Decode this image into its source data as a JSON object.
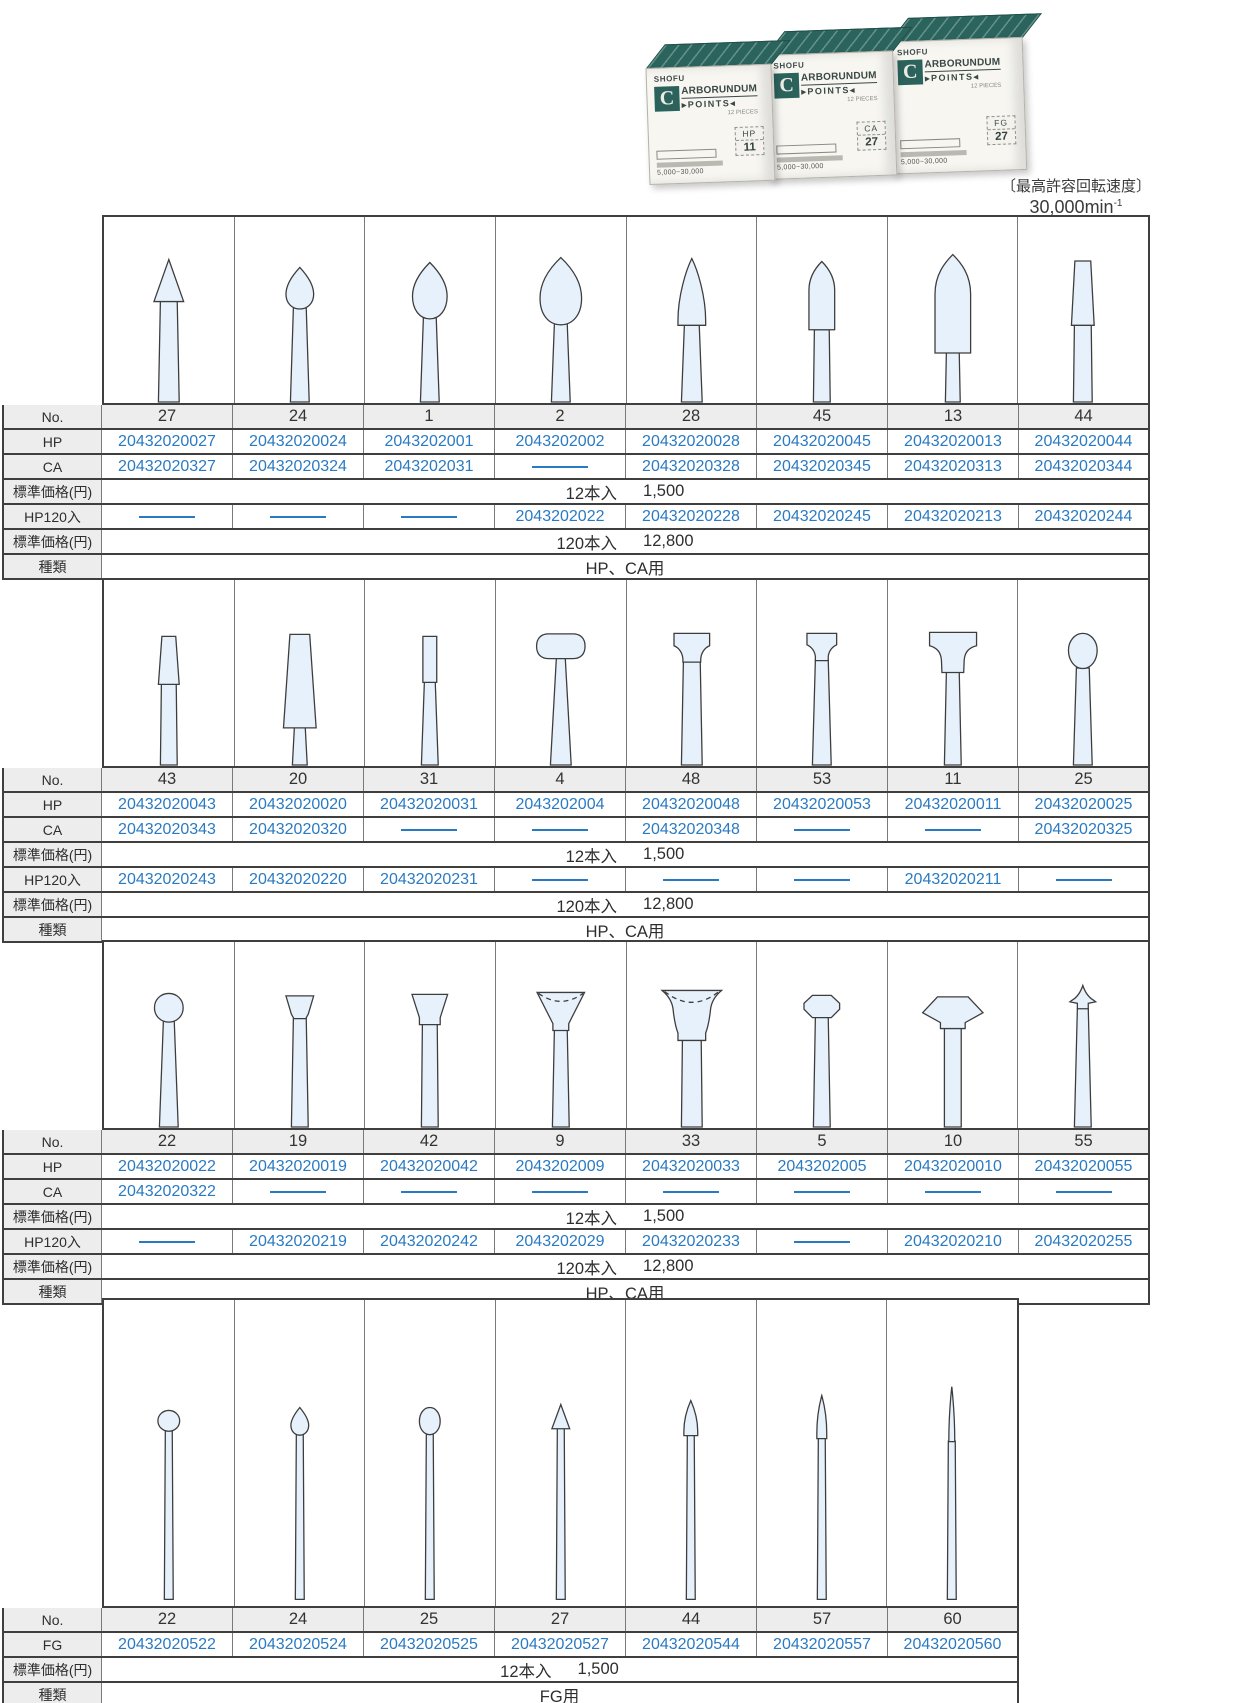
{
  "colors": {
    "code_blue": "#2a7ac2",
    "box_teal": "#2b635c",
    "row_gray": "#ededed"
  },
  "photo": {
    "brand": "SHOFU",
    "logo_letter": "C",
    "title_rest": "ARBORUNDUM",
    "subtitle": "POINTS",
    "pieces": "12 PIECES",
    "speed_text": "5,000~30,000",
    "boxes": [
      {
        "type": "HP",
        "no": "11"
      },
      {
        "type": "CA",
        "no": "27"
      },
      {
        "type": "FG",
        "no": "27"
      }
    ]
  },
  "speed_note": {
    "line1": "〔最高許容回転速度〕",
    "value": "30,000",
    "unit": "min",
    "exp": "-1"
  },
  "row_labels": {
    "no": "No.",
    "hp": "HP",
    "ca": "CA",
    "fg": "FG",
    "hp120": "HP120入",
    "price": "標準価格(円)",
    "kind": "種類"
  },
  "tables": [
    {
      "group": "HP/CA points 1",
      "columns": [
        {
          "no": "27",
          "shape": "cone27",
          "hp": "20432020027",
          "ca": "20432020327",
          "hp120": null
        },
        {
          "no": "24",
          "shape": "bud24",
          "hp": "20432020024",
          "ca": "20432020324",
          "hp120": null
        },
        {
          "no": "1",
          "shape": "bud1",
          "hp": "2043202001",
          "ca": "2043202031",
          "hp120": null
        },
        {
          "no": "2",
          "shape": "bud2",
          "hp": "2043202002",
          "ca": null,
          "hp120": "2043202022"
        },
        {
          "no": "28",
          "shape": "flame28",
          "hp": "20432020028",
          "ca": "20432020328",
          "hp120": "20432020228"
        },
        {
          "no": "45",
          "shape": "bullet45",
          "hp": "20432020045",
          "ca": "20432020345",
          "hp120": "20432020245"
        },
        {
          "no": "13",
          "shape": "torpedo13",
          "hp": "20432020013",
          "ca": "20432020313",
          "hp120": "20432020213"
        },
        {
          "no": "44",
          "shape": "taper44",
          "hp": "20432020044",
          "ca": "20432020344",
          "hp120": "20432020244"
        }
      ],
      "price12_label": "12本入",
      "price12": "1,500",
      "price120_label": "120本入",
      "price120": "12,800",
      "kind": "HP、CA用"
    },
    {
      "group": "HP/CA points 2",
      "columns": [
        {
          "no": "43",
          "shape": "taper43",
          "hp": "20432020043",
          "ca": "20432020343",
          "hp120": "20432020243"
        },
        {
          "no": "20",
          "shape": "taper20",
          "hp": "20432020020",
          "ca": "20432020320",
          "hp120": "20432020220"
        },
        {
          "no": "31",
          "shape": "cyl31",
          "hp": "20432020031",
          "ca": null,
          "hp120": "20432020231"
        },
        {
          "no": "4",
          "shape": "pill4",
          "hp": "2043202004",
          "ca": null,
          "hp120": null
        },
        {
          "no": "48",
          "shape": "tbar48",
          "hp": "20432020048",
          "ca": "20432020348",
          "hp120": null
        },
        {
          "no": "53",
          "shape": "tbar53",
          "hp": "20432020053",
          "ca": null,
          "hp120": null
        },
        {
          "no": "11",
          "shape": "tbar11",
          "hp": "20432020011",
          "ca": null,
          "hp120": "20432020211"
        },
        {
          "no": "25",
          "shape": "knob25",
          "hp": "20432020025",
          "ca": "20432020325",
          "hp120": null
        }
      ],
      "price12_label": "12本入",
      "price12": "1,500",
      "price120_label": "120本入",
      "price120": "12,800",
      "kind": "HP、CA用"
    },
    {
      "group": "HP/CA points 3",
      "columns": [
        {
          "no": "22",
          "shape": "ball22",
          "hp": "20432020022",
          "ca": "20432020322",
          "hp120": null
        },
        {
          "no": "19",
          "shape": "invcone19",
          "hp": "20432020019",
          "ca": null,
          "hp120": "20432020219"
        },
        {
          "no": "42",
          "shape": "invcone42",
          "hp": "20432020042",
          "ca": null,
          "hp120": "20432020242"
        },
        {
          "no": "9",
          "shape": "cup9",
          "hp": "2043202009",
          "ca": null,
          "hp120": "2043202029"
        },
        {
          "no": "33",
          "shape": "cup33",
          "hp": "20432020033",
          "ca": null,
          "hp120": "20432020233"
        },
        {
          "no": "5",
          "shape": "hex5",
          "hp": "2043202005",
          "ca": null,
          "hp120": null
        },
        {
          "no": "10",
          "shape": "diamond10",
          "hp": "20432020010",
          "ca": null,
          "hp120": "20432020210"
        },
        {
          "no": "55",
          "shape": "arrow55",
          "hp": "20432020055",
          "ca": null,
          "hp120": "20432020255"
        }
      ],
      "price12_label": "12本入",
      "price12": "1,500",
      "price120_label": "120本入",
      "price120": "12,800",
      "kind": "HP、CA用"
    },
    {
      "group": "FG points",
      "columns": [
        {
          "no": "22",
          "shape": "fgball22",
          "fg": "20432020522"
        },
        {
          "no": "24",
          "shape": "fgbud24",
          "fg": "20432020524"
        },
        {
          "no": "25",
          "shape": "fgegg25",
          "fg": "20432020525"
        },
        {
          "no": "27",
          "shape": "fgcone27",
          "fg": "20432020527"
        },
        {
          "no": "44",
          "shape": "fgflame44",
          "fg": "20432020544"
        },
        {
          "no": "57",
          "shape": "fgtaper57",
          "fg": "20432020557"
        },
        {
          "no": "60",
          "shape": "fgneedle60",
          "fg": "20432020560"
        }
      ],
      "price12_label": "12本入",
      "price12": "1,500",
      "kind": "FG用"
    }
  ]
}
